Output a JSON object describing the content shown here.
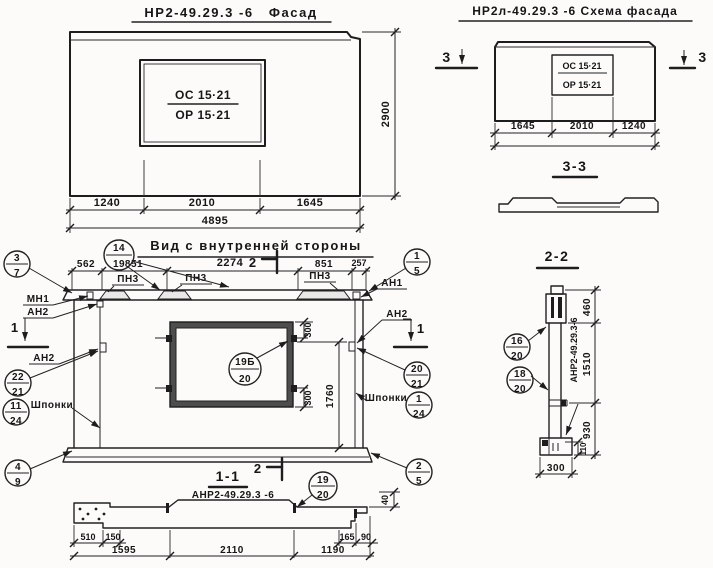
{
  "colors": {
    "ink": "#1d1d1d",
    "paper": "#fcfbf9",
    "window_band": "#4d4d4d"
  },
  "facade": {
    "title": "НР2-49.29.3 -6   Фасад",
    "window_top": "ОС 15·21",
    "window_bottom": "ОР 15·21",
    "dims": {
      "a": "1240",
      "b": "2010",
      "c": "1645",
      "total": "4895",
      "height": "2900"
    }
  },
  "schema": {
    "title": "НР2л-49.29.3 -6 Схема фасада",
    "window_top": "ОС 15·21",
    "window_bottom": "ОР 15·21",
    "dims": {
      "a": "1645",
      "b": "2010",
      "c": "1240"
    },
    "marker": "3"
  },
  "section33": {
    "title": "3-3"
  },
  "view": {
    "title": "Вид с внутренней стороны",
    "top_dims": [
      "562",
      "851",
      "2274",
      "851",
      "257"
    ],
    "marker1": "1",
    "marker2": "2",
    "pn3": "ПН3",
    "mn1": "МН1",
    "an1": "АН1",
    "an2": "АН2",
    "shponki": "Шпонки",
    "dim300": "300",
    "dim1760": "1760",
    "balloons": {
      "b14_19": {
        "t": "14",
        "b": "19"
      },
      "b3_7": {
        "t": "3",
        "b": "7"
      },
      "b1_5": {
        "t": "1",
        "b": "5"
      },
      "b22_21": {
        "t": "22",
        "b": "21"
      },
      "b11_24": {
        "t": "11",
        "b": "24"
      },
      "b20_21": {
        "t": "20",
        "b": "21"
      },
      "b1_24": {
        "t": "1",
        "b": "24"
      },
      "b19b_20": {
        "t": "19Б",
        "b": "20"
      },
      "b4_9": {
        "t": "4",
        "b": "9"
      },
      "b2_5": {
        "t": "2",
        "b": "5"
      }
    }
  },
  "section11": {
    "title": "1-1",
    "label": "АНР2-49.29.3 -6",
    "balloon": {
      "t": "19",
      "b": "20"
    },
    "dims": {
      "d510": "510",
      "d150": "150",
      "d1595": "1595",
      "d2110": "2110",
      "d1190": "1190",
      "d165": "165",
      "d90": "90",
      "d40": "40"
    }
  },
  "section22": {
    "title": "2-2",
    "vlabel": "АНР2-49.29.3-6",
    "b16": {
      "t": "16",
      "b": "20"
    },
    "b18": {
      "t": "18",
      "b": "20"
    },
    "dims": {
      "d460": "460",
      "d1510": "1510",
      "d930": "930",
      "d300": "300",
      "d110": "110"
    }
  }
}
